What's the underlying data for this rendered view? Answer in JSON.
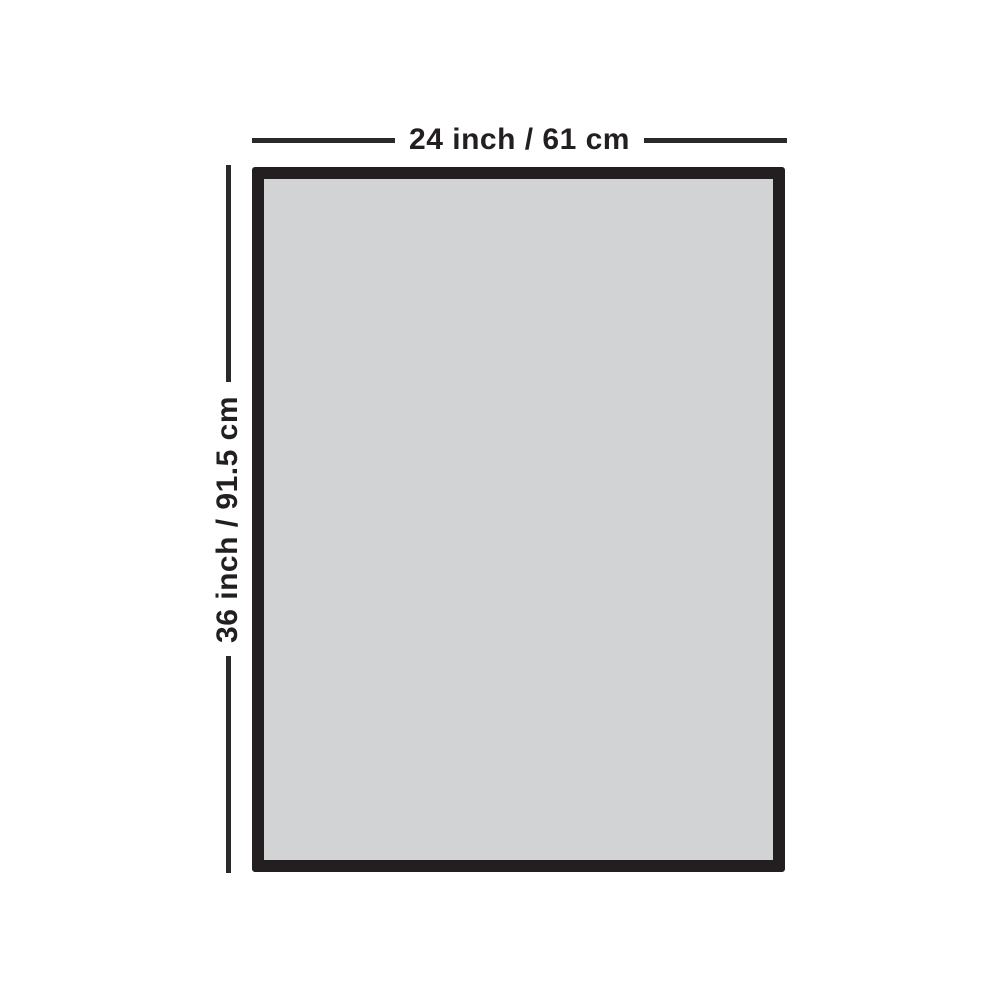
{
  "diagram": {
    "title": "rectangular-panel-dimension-diagram",
    "width_dimension": {
      "label": "24 inch / 61 cm"
    },
    "height_dimension": {
      "label": "36 inch / 91.5 cm"
    }
  },
  "colors": {
    "background": "#ffffff",
    "fill": "#d2d3d4",
    "border": "#231f20",
    "line": "#2b2a2b",
    "text": "#231f20"
  }
}
